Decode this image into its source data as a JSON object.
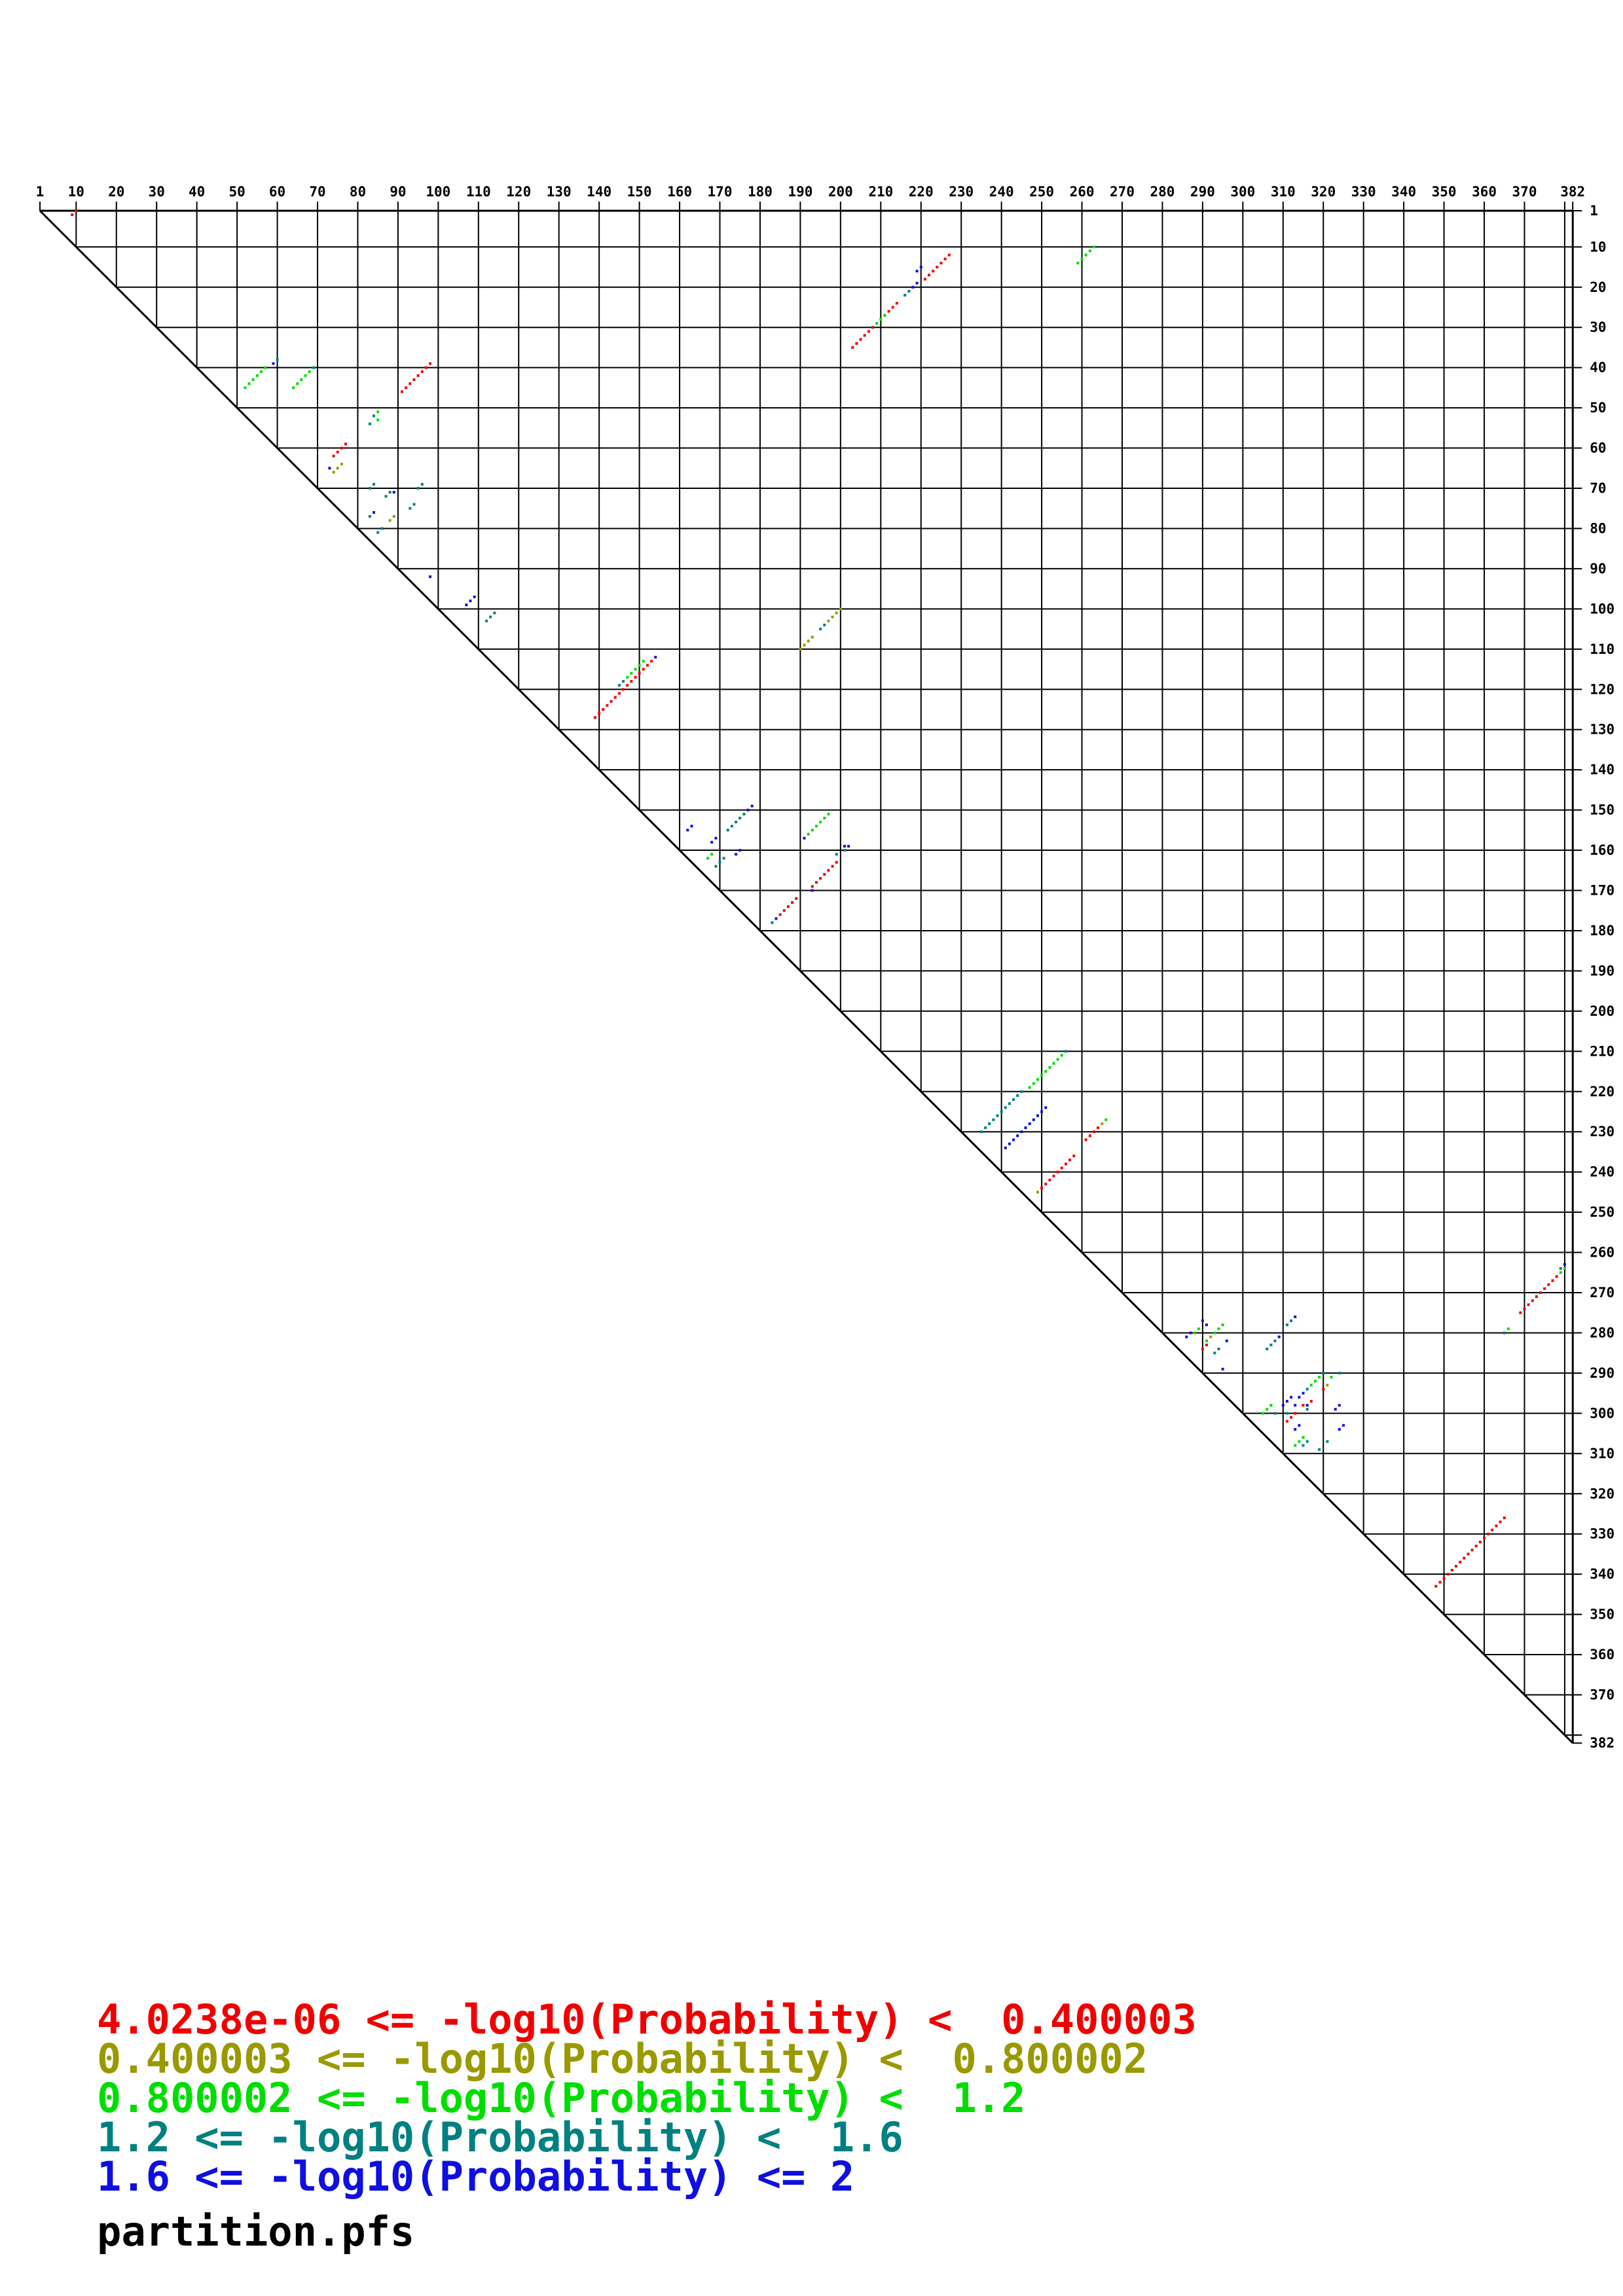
{
  "legend": {
    "items": [
      {
        "text": "4.0238e-06 <= -log10(Probability) <  0.400003",
        "color": "#f00000"
      },
      {
        "text": "0.400003 <= -log10(Probability) <  0.800002",
        "color": "#999900"
      },
      {
        "text": "0.800002 <= -log10(Probability) <  1.2",
        "color": "#00dd00"
      },
      {
        "text": "1.2 <= -log10(Probability) <  1.6",
        "color": "#008080"
      },
      {
        "text": "1.6 <= -log10(Probability) <= 2",
        "color": "#0f0fe0"
      }
    ],
    "filename": "partition.pfs"
  },
  "chart_data": {
    "type": "scatter",
    "subtype": "rna-base-pair-probability-dot-plot",
    "title": "partition.pfs",
    "sequence_length": 382,
    "axis": {
      "tick_interval": 10,
      "top_labels": [
        1,
        10,
        20,
        30,
        40,
        50,
        60,
        70,
        80,
        90,
        100,
        110,
        120,
        130,
        140,
        150,
        160,
        170,
        180,
        190,
        200,
        210,
        220,
        230,
        240,
        250,
        260,
        270,
        280,
        290,
        300,
        310,
        320,
        330,
        340,
        350,
        360,
        370,
        382
      ],
      "right_labels": [
        1,
        10,
        20,
        30,
        40,
        50,
        60,
        70,
        80,
        90,
        100,
        110,
        120,
        130,
        140,
        150,
        160,
        170,
        180,
        190,
        200,
        210,
        220,
        230,
        240,
        250,
        260,
        270,
        280,
        290,
        300,
        310,
        320,
        330,
        340,
        350,
        360,
        370,
        382
      ],
      "grid": true
    },
    "colors": {
      "red": "#f00000",
      "olive": "#999900",
      "green": "#00dd00",
      "teal": "#008080",
      "blue": "#0f0fe0"
    },
    "legend_position": "bottom-left",
    "helices": [
      {
        "c": "red",
        "i": 1,
        "j": 10,
        "n": 2
      },
      {
        "c": "red",
        "i": 12,
        "j": 227,
        "n": 7
      },
      {
        "c": "red",
        "i": 24,
        "j": 214,
        "n": 4
      },
      {
        "c": "red",
        "i": 30,
        "j": 208,
        "n": 6
      },
      {
        "c": "red",
        "i": 39,
        "j": 98,
        "n": 8
      },
      {
        "c": "red",
        "i": 59,
        "j": 77,
        "n": 4
      },
      {
        "c": "red",
        "i": 113,
        "j": 153,
        "n": 15
      },
      {
        "c": "red",
        "i": 163,
        "j": 199,
        "n": 7
      },
      {
        "c": "red",
        "i": 172,
        "j": 189,
        "n": 5
      },
      {
        "c": "red",
        "i": 229,
        "j": 264,
        "n": 4
      },
      {
        "c": "red",
        "i": 236,
        "j": 258,
        "n": 9
      },
      {
        "c": "red",
        "i": 266,
        "j": 378,
        "n": 10
      },
      {
        "c": "red",
        "i": 283,
        "j": 291,
        "n": 2
      },
      {
        "c": "red",
        "i": 294,
        "j": 320,
        "n": 1
      },
      {
        "c": "red",
        "i": 297,
        "j": 317,
        "n": 1
      },
      {
        "c": "red",
        "i": 298,
        "j": 315,
        "n": 1
      },
      {
        "c": "red",
        "i": 300,
        "j": 313,
        "n": 3
      },
      {
        "c": "red",
        "i": 326,
        "j": 365,
        "n": 18
      },
      {
        "c": "olive",
        "i": 64,
        "j": 76,
        "n": 3
      },
      {
        "c": "olive",
        "i": 77,
        "j": 89,
        "n": 2
      },
      {
        "c": "olive",
        "i": 100,
        "j": 200,
        "n": 4
      },
      {
        "c": "olive",
        "i": 107,
        "j": 193,
        "n": 4
      },
      {
        "c": "olive",
        "i": 228,
        "j": 265,
        "n": 1
      },
      {
        "c": "olive",
        "i": 245,
        "j": 249,
        "n": 1
      },
      {
        "c": "olive",
        "i": 281,
        "j": 292,
        "n": 1
      },
      {
        "c": "olive",
        "i": 293,
        "j": 321,
        "n": 1
      },
      {
        "c": "green",
        "i": 10,
        "j": 263,
        "n": 5
      },
      {
        "c": "green",
        "i": 27,
        "j": 211,
        "n": 1
      },
      {
        "c": "green",
        "i": 28,
        "j": 210,
        "n": 2
      },
      {
        "c": "green",
        "i": 40,
        "j": 57,
        "n": 6
      },
      {
        "c": "green",
        "i": 41,
        "j": 68,
        "n": 5
      },
      {
        "c": "green",
        "i": 51,
        "j": 85,
        "n": 1
      },
      {
        "c": "green",
        "i": 53,
        "j": 85,
        "n": 1
      },
      {
        "c": "green",
        "i": 113,
        "j": 151,
        "n": 5
      },
      {
        "c": "green",
        "i": 151,
        "j": 197,
        "n": 6
      },
      {
        "c": "green",
        "i": 161,
        "j": 168,
        "n": 2
      },
      {
        "c": "green",
        "i": 211,
        "j": 255,
        "n": 9
      },
      {
        "c": "green",
        "i": 227,
        "j": 266,
        "n": 1
      },
      {
        "c": "green",
        "i": 264,
        "j": 380,
        "n": 1
      },
      {
        "c": "green",
        "i": 265,
        "j": 379,
        "n": 1
      },
      {
        "c": "green",
        "i": 278,
        "j": 295,
        "n": 3
      },
      {
        "c": "green",
        "i": 279,
        "j": 289,
        "n": 1
      },
      {
        "c": "green",
        "i": 280,
        "j": 288,
        "n": 1
      },
      {
        "c": "green",
        "i": 282,
        "j": 291,
        "n": 1
      },
      {
        "c": "green",
        "i": 279,
        "j": 366,
        "n": 1
      },
      {
        "c": "green",
        "i": 291,
        "j": 319,
        "n": 3
      },
      {
        "c": "green",
        "i": 291,
        "j": 322,
        "n": 1
      },
      {
        "c": "green",
        "i": 298,
        "j": 307,
        "n": 3
      },
      {
        "c": "green",
        "i": 306,
        "j": 315,
        "n": 3
      },
      {
        "c": "teal",
        "i": 21,
        "j": 217,
        "n": 2
      },
      {
        "c": "teal",
        "i": 38,
        "j": 60,
        "n": 1
      },
      {
        "c": "teal",
        "i": 40,
        "j": 69,
        "n": 1
      },
      {
        "c": "teal",
        "i": 52,
        "j": 84,
        "n": 1
      },
      {
        "c": "teal",
        "i": 54,
        "j": 83,
        "n": 1
      },
      {
        "c": "teal",
        "i": 69,
        "j": 84,
        "n": 2
      },
      {
        "c": "teal",
        "i": 69,
        "j": 96,
        "n": 2
      },
      {
        "c": "teal",
        "i": 71,
        "j": 88,
        "n": 2
      },
      {
        "c": "teal",
        "i": 74,
        "j": 94,
        "n": 2
      },
      {
        "c": "teal",
        "i": 77,
        "j": 83,
        "n": 1
      },
      {
        "c": "teal",
        "i": 80,
        "j": 86,
        "n": 2
      },
      {
        "c": "teal",
        "i": 101,
        "j": 114,
        "n": 3
      },
      {
        "c": "teal",
        "i": 104,
        "j": 196,
        "n": 2
      },
      {
        "c": "teal",
        "i": 118,
        "j": 146,
        "n": 2
      },
      {
        "c": "teal",
        "i": 151,
        "j": 176,
        "n": 5
      },
      {
        "c": "teal",
        "i": 160,
        "j": 201,
        "n": 1
      },
      {
        "c": "teal",
        "i": 161,
        "j": 199,
        "n": 1
      },
      {
        "c": "teal",
        "i": 162,
        "j": 171,
        "n": 3
      },
      {
        "c": "teal",
        "i": 178,
        "j": 183,
        "n": 1
      },
      {
        "c": "teal",
        "i": 210,
        "j": 256,
        "n": 1
      },
      {
        "c": "teal",
        "i": 220,
        "j": 245,
        "n": 11
      },
      {
        "c": "teal",
        "i": 264,
        "j": 379,
        "n": 1
      },
      {
        "c": "teal",
        "i": 277,
        "j": 312,
        "n": 2
      },
      {
        "c": "teal",
        "i": 280,
        "j": 365,
        "n": 1
      },
      {
        "c": "teal",
        "i": 282,
        "j": 308,
        "n": 3
      },
      {
        "c": "teal",
        "i": 284,
        "j": 294,
        "n": 2
      },
      {
        "c": "teal",
        "i": 290,
        "j": 320,
        "n": 1
      },
      {
        "c": "teal",
        "i": 290,
        "j": 324,
        "n": 1
      },
      {
        "c": "teal",
        "i": 294,
        "j": 316,
        "n": 1
      },
      {
        "c": "teal",
        "i": 299,
        "j": 316,
        "n": 1
      },
      {
        "c": "teal",
        "i": 300,
        "j": 308,
        "n": 1
      },
      {
        "c": "teal",
        "i": 300,
        "j": 311,
        "n": 1
      },
      {
        "c": "teal",
        "i": 307,
        "j": 316,
        "n": 1
      },
      {
        "c": "teal",
        "i": 308,
        "j": 315,
        "n": 1
      },
      {
        "c": "teal",
        "i": 307,
        "j": 321,
        "n": 1
      },
      {
        "c": "teal",
        "i": 309,
        "j": 319,
        "n": 1
      },
      {
        "c": "blue",
        "i": 15,
        "j": 220,
        "n": 2
      },
      {
        "c": "blue",
        "i": 19,
        "j": 219,
        "n": 2
      },
      {
        "c": "blue",
        "i": 39,
        "j": 59,
        "n": 1
      },
      {
        "c": "blue",
        "i": 65,
        "j": 73,
        "n": 1
      },
      {
        "c": "blue",
        "i": 71,
        "j": 89,
        "n": 1
      },
      {
        "c": "blue",
        "i": 76,
        "j": 84,
        "n": 1
      },
      {
        "c": "blue",
        "i": 92,
        "j": 98,
        "n": 1
      },
      {
        "c": "blue",
        "i": 97,
        "j": 109,
        "n": 3
      },
      {
        "c": "blue",
        "i": 112,
        "j": 154,
        "n": 1
      },
      {
        "c": "blue",
        "i": 149,
        "j": 178,
        "n": 2
      },
      {
        "c": "blue",
        "i": 154,
        "j": 163,
        "n": 2
      },
      {
        "c": "blue",
        "i": 157,
        "j": 169,
        "n": 2
      },
      {
        "c": "blue",
        "i": 157,
        "j": 191,
        "n": 1
      },
      {
        "c": "blue",
        "i": 159,
        "j": 201,
        "n": 1
      },
      {
        "c": "blue",
        "i": 159,
        "j": 202,
        "n": 1
      },
      {
        "c": "blue",
        "i": 160,
        "j": 175,
        "n": 2
      },
      {
        "c": "blue",
        "i": 170,
        "j": 193,
        "n": 1
      },
      {
        "c": "blue",
        "i": 177,
        "j": 184,
        "n": 1
      },
      {
        "c": "blue",
        "i": 224,
        "j": 251,
        "n": 11
      },
      {
        "c": "blue",
        "i": 263,
        "j": 380,
        "n": 1
      },
      {
        "c": "blue",
        "i": 276,
        "j": 313,
        "n": 1
      },
      {
        "c": "blue",
        "i": 277,
        "j": 290,
        "n": 1
      },
      {
        "c": "blue",
        "i": 278,
        "j": 291,
        "n": 1
      },
      {
        "c": "blue",
        "i": 280,
        "j": 287,
        "n": 1
      },
      {
        "c": "blue",
        "i": 281,
        "j": 286,
        "n": 1
      },
      {
        "c": "blue",
        "i": 281,
        "j": 309,
        "n": 1
      },
      {
        "c": "blue",
        "i": 282,
        "j": 296,
        "n": 1
      },
      {
        "c": "blue",
        "i": 289,
        "j": 295,
        "n": 1
      },
      {
        "c": "blue",
        "i": 295,
        "j": 315,
        "n": 2
      },
      {
        "c": "blue",
        "i": 296,
        "j": 312,
        "n": 3
      },
      {
        "c": "blue",
        "i": 298,
        "j": 313,
        "n": 1
      },
      {
        "c": "blue",
        "i": 298,
        "j": 316,
        "n": 1
      },
      {
        "c": "blue",
        "i": 298,
        "j": 324,
        "n": 2
      },
      {
        "c": "blue",
        "i": 303,
        "j": 314,
        "n": 1
      },
      {
        "c": "blue",
        "i": 304,
        "j": 313,
        "n": 1
      },
      {
        "c": "blue",
        "i": 303,
        "j": 325,
        "n": 1
      },
      {
        "c": "blue",
        "i": 304,
        "j": 324,
        "n": 1
      }
    ]
  }
}
